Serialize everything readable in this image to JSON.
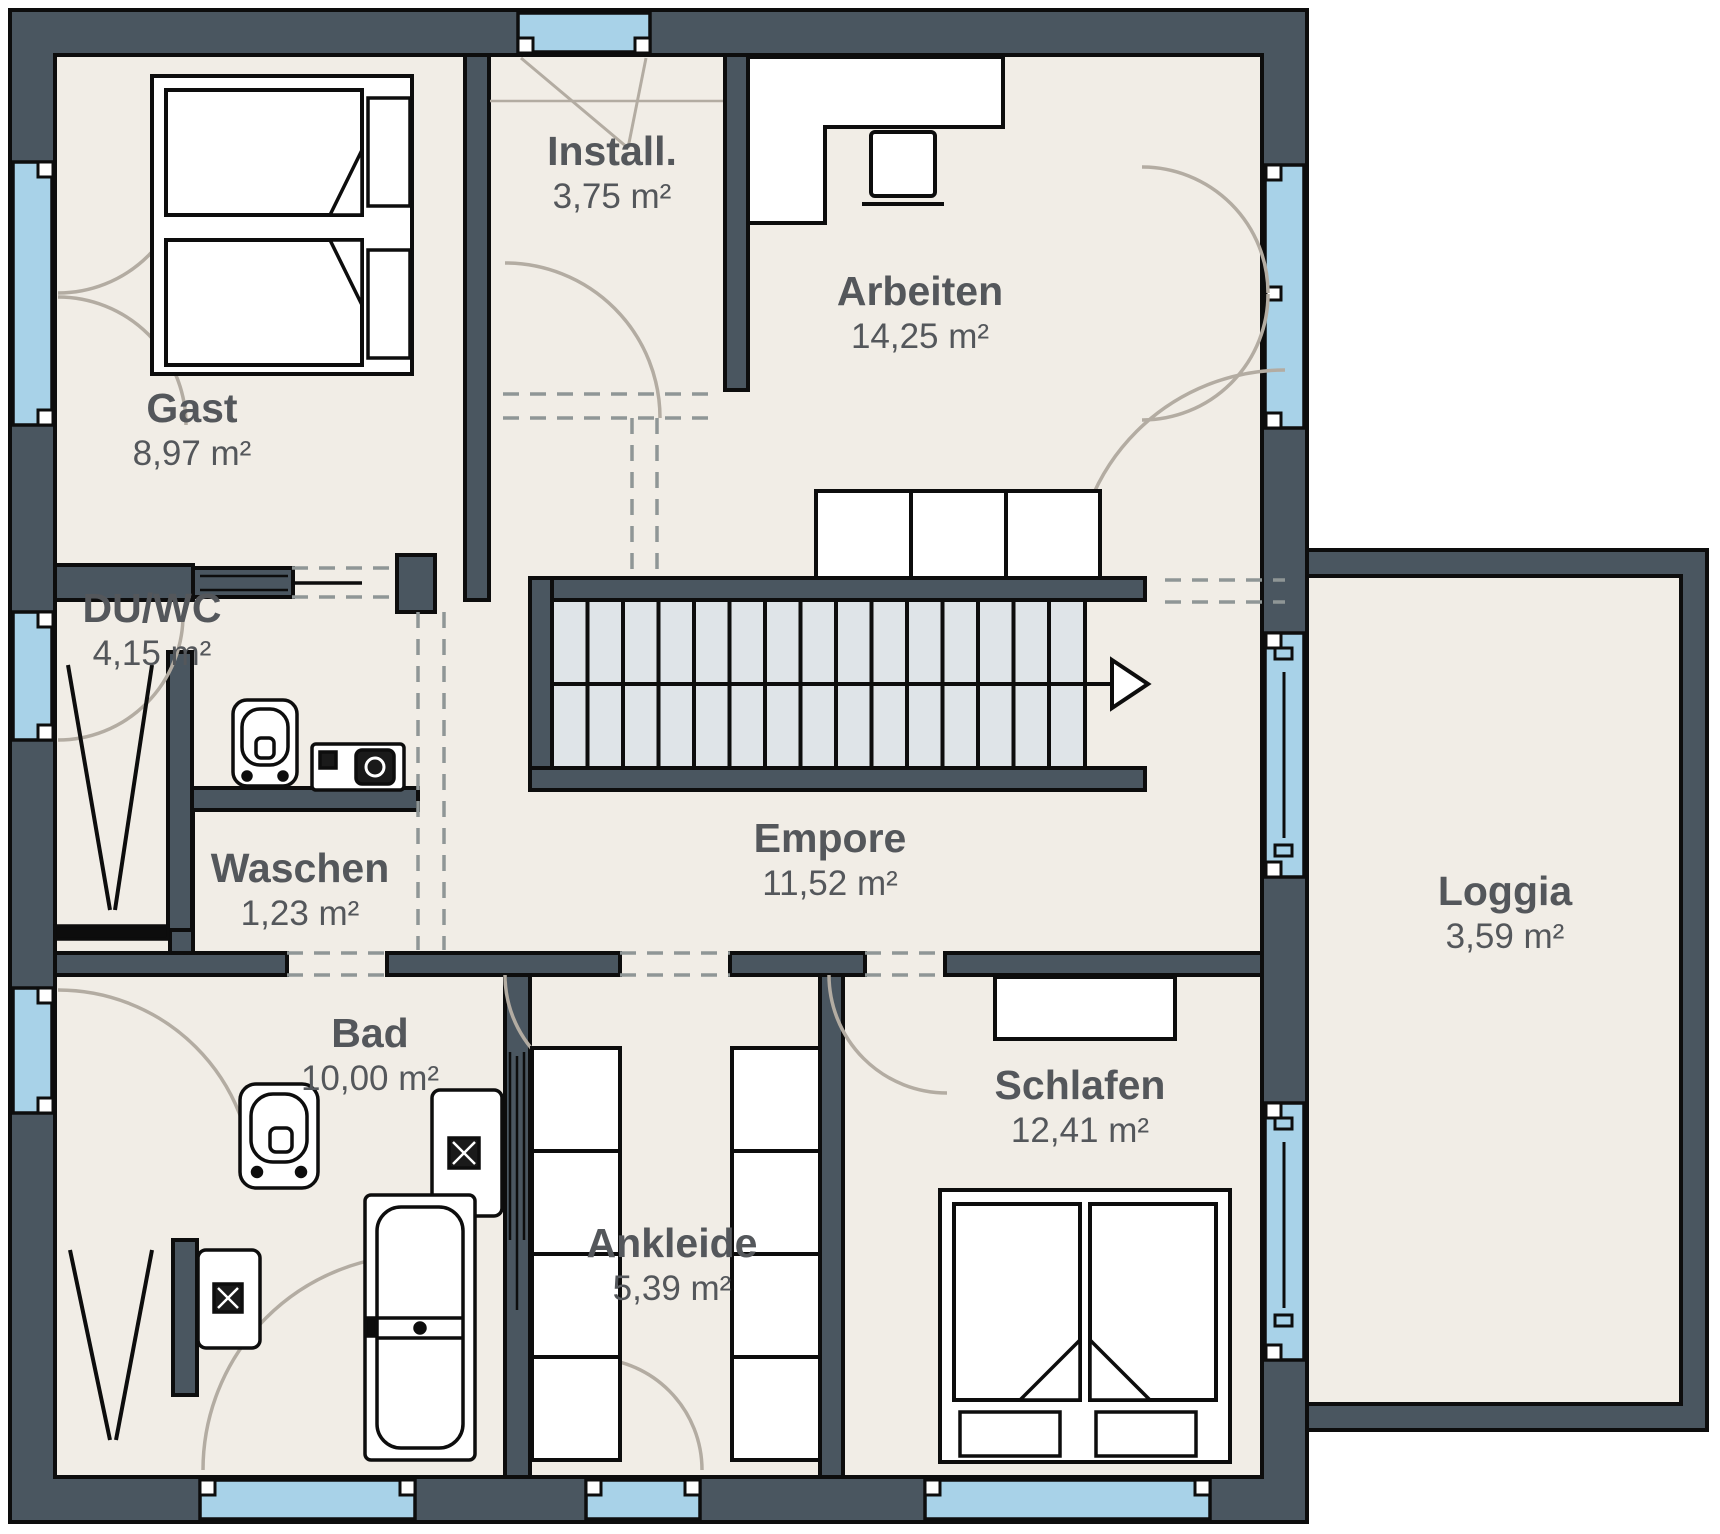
{
  "plan": {
    "title": "Obergeschoss Grundriss",
    "unit": "m²",
    "colors": {
      "wall": "#4a5660",
      "floor": "#f1ede6",
      "window_glass": "#a8d2e8",
      "outline": "#0d0d0d",
      "label_text": "#54575b",
      "stair_tread": "#dfe4e8",
      "door_swing": "#b3aca2",
      "opening_dash": "#8f9696"
    },
    "rooms": {
      "gast": {
        "name": "Gast",
        "area": "8,97 m²"
      },
      "install": {
        "name": "Install.",
        "area": "3,75 m²"
      },
      "arbeiten": {
        "name": "Arbeiten",
        "area": "14,25 m²"
      },
      "duwc": {
        "name": "DU/WC",
        "area": "4,15 m²"
      },
      "waschen": {
        "name": "Waschen",
        "area": "1,23 m²"
      },
      "empore": {
        "name": "Empore",
        "area": "11,52 m²"
      },
      "bad": {
        "name": "Bad",
        "area": "10,00 m²"
      },
      "ankleide": {
        "name": "Ankleide",
        "area": "5,39 m²"
      },
      "schlafen": {
        "name": "Schlafen",
        "area": "12,41 m²"
      },
      "loggia": {
        "name": "Loggia",
        "area": "3,59 m²"
      }
    }
  }
}
